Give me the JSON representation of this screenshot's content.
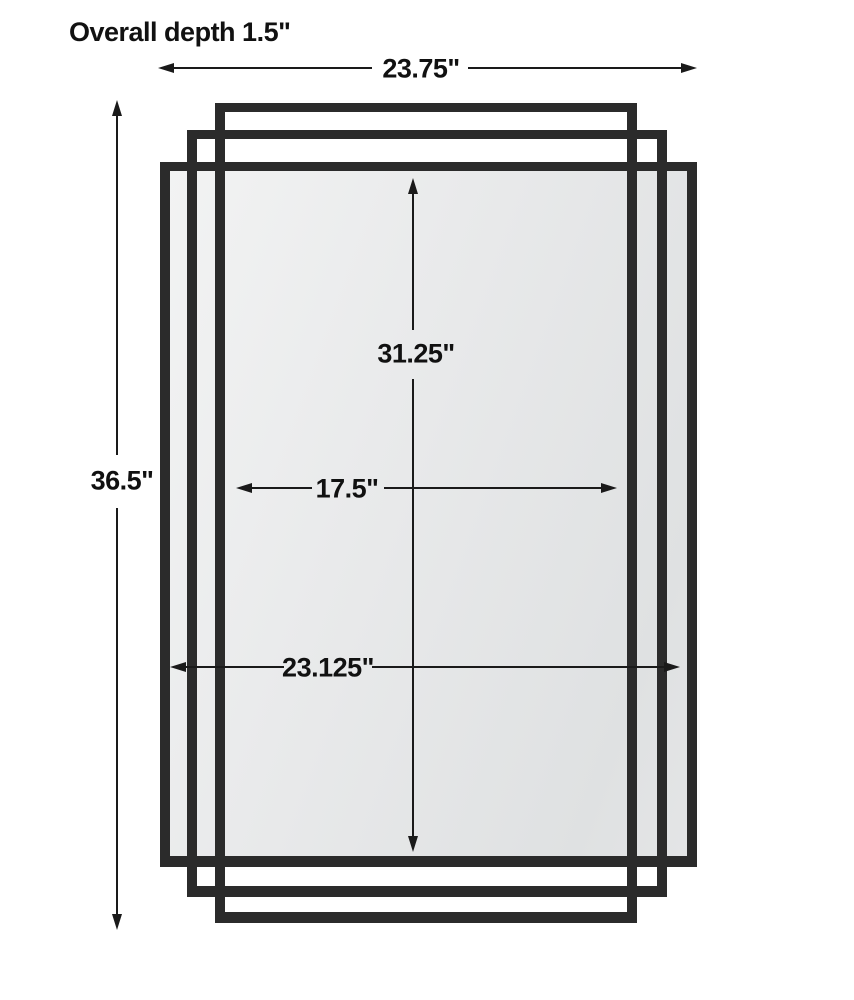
{
  "title": "Mirror dimension diagram",
  "colors": {
    "background": "#ffffff",
    "frame": "#2b2b2b",
    "line": "#1a1a1a",
    "text": "#111111",
    "glass_light": "#f2f3f3",
    "glass_dark": "#dfe1e2"
  },
  "annotations": {
    "overall_depth": "Overall depth 1.5\""
  },
  "dimensions": {
    "overall_width": "23.75\"",
    "overall_height": "36.5\"",
    "mirror_height": "31.25\"",
    "inner_width": "17.5\"",
    "mirror_width": "23.125\""
  }
}
